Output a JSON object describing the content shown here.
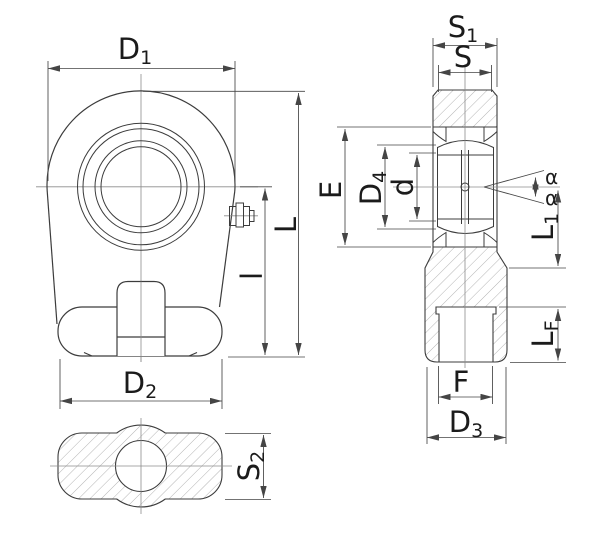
{
  "drawing": {
    "type": "technical-drawing",
    "subject": "rod end (piston rod eye) with spherical plain bearing, front view, section side view and bottom section view with dimension callouts"
  },
  "colors": {
    "background": "#ffffff",
    "part_line": "#3c3c3c",
    "dim_line": "#454545",
    "center_line": "#8c8c8c",
    "hatch": "#9b9b9b",
    "text": "#1b1b1b"
  },
  "labels": {
    "D1": {
      "base": "D",
      "sub": "1"
    },
    "L": {
      "base": "L",
      "sub": ""
    },
    "l": {
      "base": "l",
      "sub": ""
    },
    "D2": {
      "base": "D",
      "sub": "2"
    },
    "S2": {
      "base": "S",
      "sub": "2"
    },
    "S1": {
      "base": "S",
      "sub": "1"
    },
    "S": {
      "base": "S",
      "sub": ""
    },
    "E": {
      "base": "E",
      "sub": ""
    },
    "D4": {
      "base": "D",
      "sub": "4"
    },
    "d": {
      "base": "d",
      "sub": ""
    },
    "alpha_upper": {
      "base": "α",
      "sub": ""
    },
    "alpha_lower": {
      "base": "α",
      "sub": ""
    },
    "L1": {
      "base": "L",
      "sub": "1"
    },
    "LF": {
      "base": "L",
      "sub": "F"
    },
    "F": {
      "base": "F",
      "sub": ""
    },
    "D3": {
      "base": "D",
      "sub": "3"
    }
  }
}
